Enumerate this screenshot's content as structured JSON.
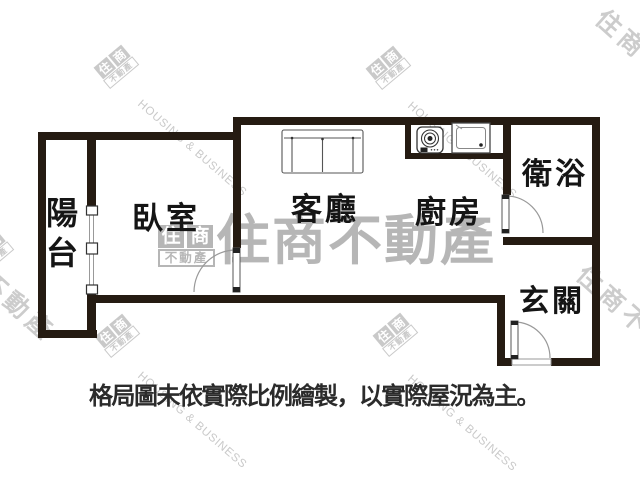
{
  "brand": {
    "name": "住商不動產",
    "tagline_en": "HOUSING & BUSINESS",
    "logo_char1": "住",
    "logo_char2": "商",
    "logo_bottom": "不動產"
  },
  "rooms": {
    "balcony": "陽台",
    "bedroom": "臥室",
    "living_room": "客廳",
    "kitchen": "廚房",
    "bathroom": "衛浴",
    "entrance": "玄關"
  },
  "disclaimer": "格局圖未依實際比例繪製，以實際屋況為主。",
  "colors": {
    "wall": "#251b12",
    "label": "#151515",
    "watermark_light": "#c9c9c9",
    "watermark_center": "#b6b6b6",
    "thin_line": "#555555",
    "arc_line": "#999999"
  }
}
